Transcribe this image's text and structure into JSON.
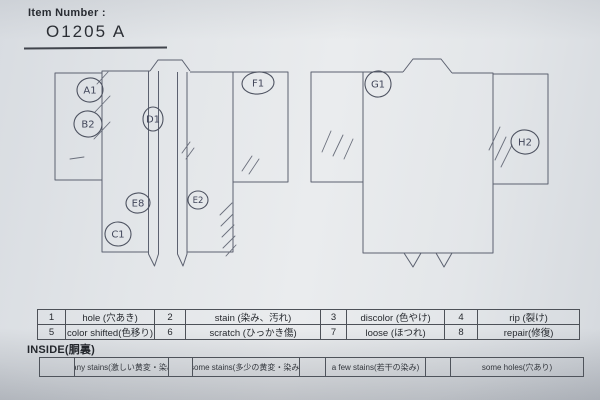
{
  "header": {
    "label": "Item Number :",
    "value": "O1205  A"
  },
  "diagrams": {
    "front": {
      "name": "kimono front view",
      "labels": [
        "A1",
        "B2",
        "D1",
        "E8",
        "E2",
        "C1",
        "F1"
      ]
    },
    "back": {
      "name": "kimono back view",
      "labels": [
        "G1",
        "H2"
      ]
    }
  },
  "legend": {
    "rows": [
      [
        {
          "num": "1",
          "label": "hole (穴あき)"
        },
        {
          "num": "2",
          "label": "stain (染み、汚れ)"
        },
        {
          "num": "3",
          "label": "discolor (色やけ)"
        },
        {
          "num": "4",
          "label": "rip (裂け)"
        }
      ],
      [
        {
          "num": "5",
          "label": "color shifted(色移り)"
        },
        {
          "num": "6",
          "label": "scratch (ひっかき傷)"
        },
        {
          "num": "7",
          "label": "loose (ほつれ)"
        },
        {
          "num": "8",
          "label": "repair(修復)"
        }
      ]
    ]
  },
  "inside": {
    "title": "INSIDE(胴裏)",
    "options": [
      "many stains(激しい黄変・染み)",
      "some stains(多少の黄変・染み)",
      "a few stains(若干の染み)",
      "some holes(穴あり)"
    ]
  },
  "colors": {
    "paper": "#e7eaec",
    "ink": "#5c6170",
    "text": "#26292e"
  }
}
